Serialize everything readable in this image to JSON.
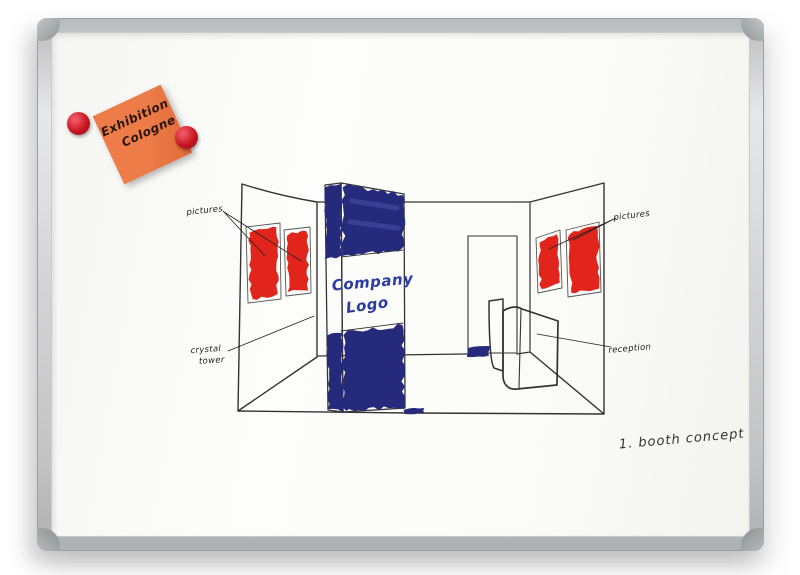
{
  "board": {
    "frame_color": "#c8cccd",
    "corner_cap_color": "#979d9e",
    "surface_color": "#fbfbf8"
  },
  "sticky_note": {
    "line1": "Exhibition",
    "line2": "Cologne",
    "note_color": "#ed7c49",
    "note_shade_color": "#df6a38",
    "magnet_color": "#c81522",
    "ink_color": "#2a150b"
  },
  "sketch": {
    "labels": {
      "pictures_left": "pictures",
      "pictures_right": "pictures",
      "crystal_line1": "crystal",
      "crystal_line2": "tower",
      "reception": "reception"
    },
    "tower_text": {
      "line1": "Company",
      "line2": "Logo"
    },
    "caption": "1. booth concept",
    "colors": {
      "red": "#e1251d",
      "navy": "#252a7c",
      "navy_light": "#5d63b8",
      "logo_blue": "#2a3ca4",
      "ink": "#333333",
      "frame_ink": "#555555",
      "label_ink": "#222222"
    }
  }
}
